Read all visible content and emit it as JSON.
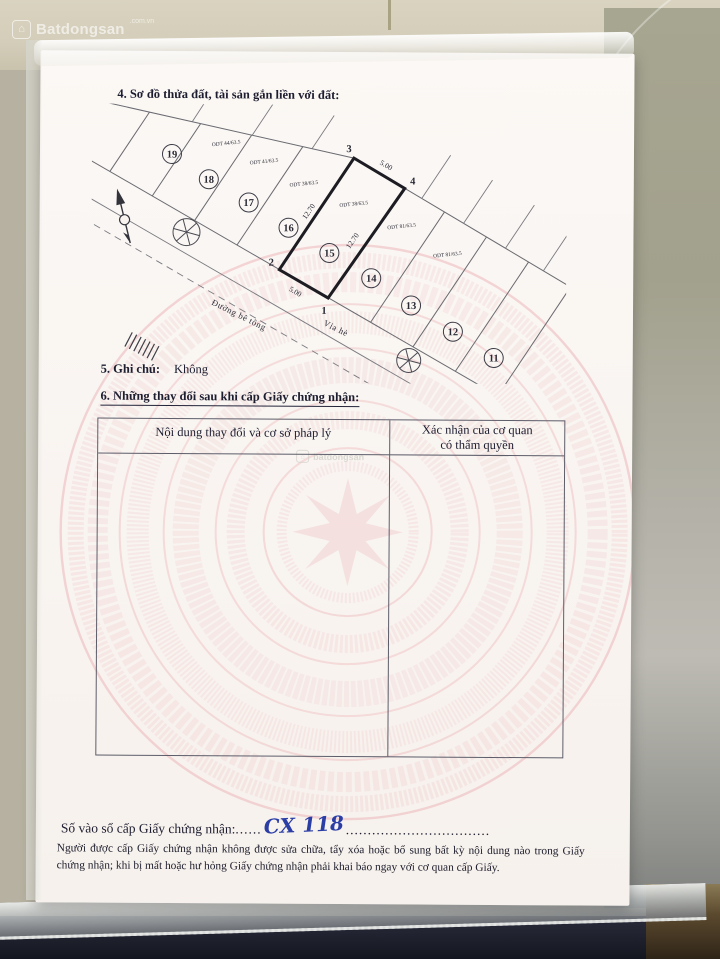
{
  "photo": {
    "brand": "Batdongsan",
    "brand_suffix": ".com.vn",
    "center_watermark": "batdongsan",
    "house_glyph": "⌂"
  },
  "sections": {
    "s4_title": "4. Sơ đồ thửa đất, tài sản gắn liền với đất:",
    "s5_label": "5. Ghi chú:",
    "s5_value": "Không",
    "s6_title": "6. Những thay đổi sau khi cấp Giấy chứng nhận:"
  },
  "diagram": {
    "parcels": [
      "19",
      "18",
      "17",
      "16",
      "15",
      "14",
      "13",
      "12",
      "11"
    ],
    "corners": [
      "1",
      "2",
      "3",
      "4"
    ],
    "edge_top": "5.00",
    "edge_bottom": "5.00",
    "edge_left": "12.70",
    "edge_right": "12.70",
    "odt_labels": [
      "ODT 44/63.5",
      "ODT 41/63.5",
      "ODT 38/63.5",
      "ODT 38/63.5",
      "ODT 81/63.5",
      "ODT 81/63.5"
    ],
    "road_label": "Đường bê tông",
    "sidewalk_label": "Vỉa hè"
  },
  "table": {
    "col1_header": "Nội dung thay đổi và cơ sở pháp lý",
    "col2_header": "Xác nhận của cơ quan\ncó thẩm quyền"
  },
  "serial": {
    "label": "Số vào sổ cấp Giấy chứng nhận:",
    "dots_left": "......",
    "value": "CX 118",
    "dots_right": "................................."
  },
  "footer_note": "Người được cấp Giấy chứng nhận không được sửa chữa, tẩy xóa hoặc bổ sung bất kỳ nội dung nào trong Giấy chứng nhận; khi bị mất hoặc hư hỏng Giấy chứng nhận phải khai báo ngay với cơ quan cấp Giấy.",
  "colors": {
    "drum_pink": "#e89aa2",
    "handwriting_blue": "#2b3ea6",
    "paper": "#f9f5f1",
    "tile_beige": "#d6d0bc",
    "sleeve_olive": "#a6a591"
  }
}
